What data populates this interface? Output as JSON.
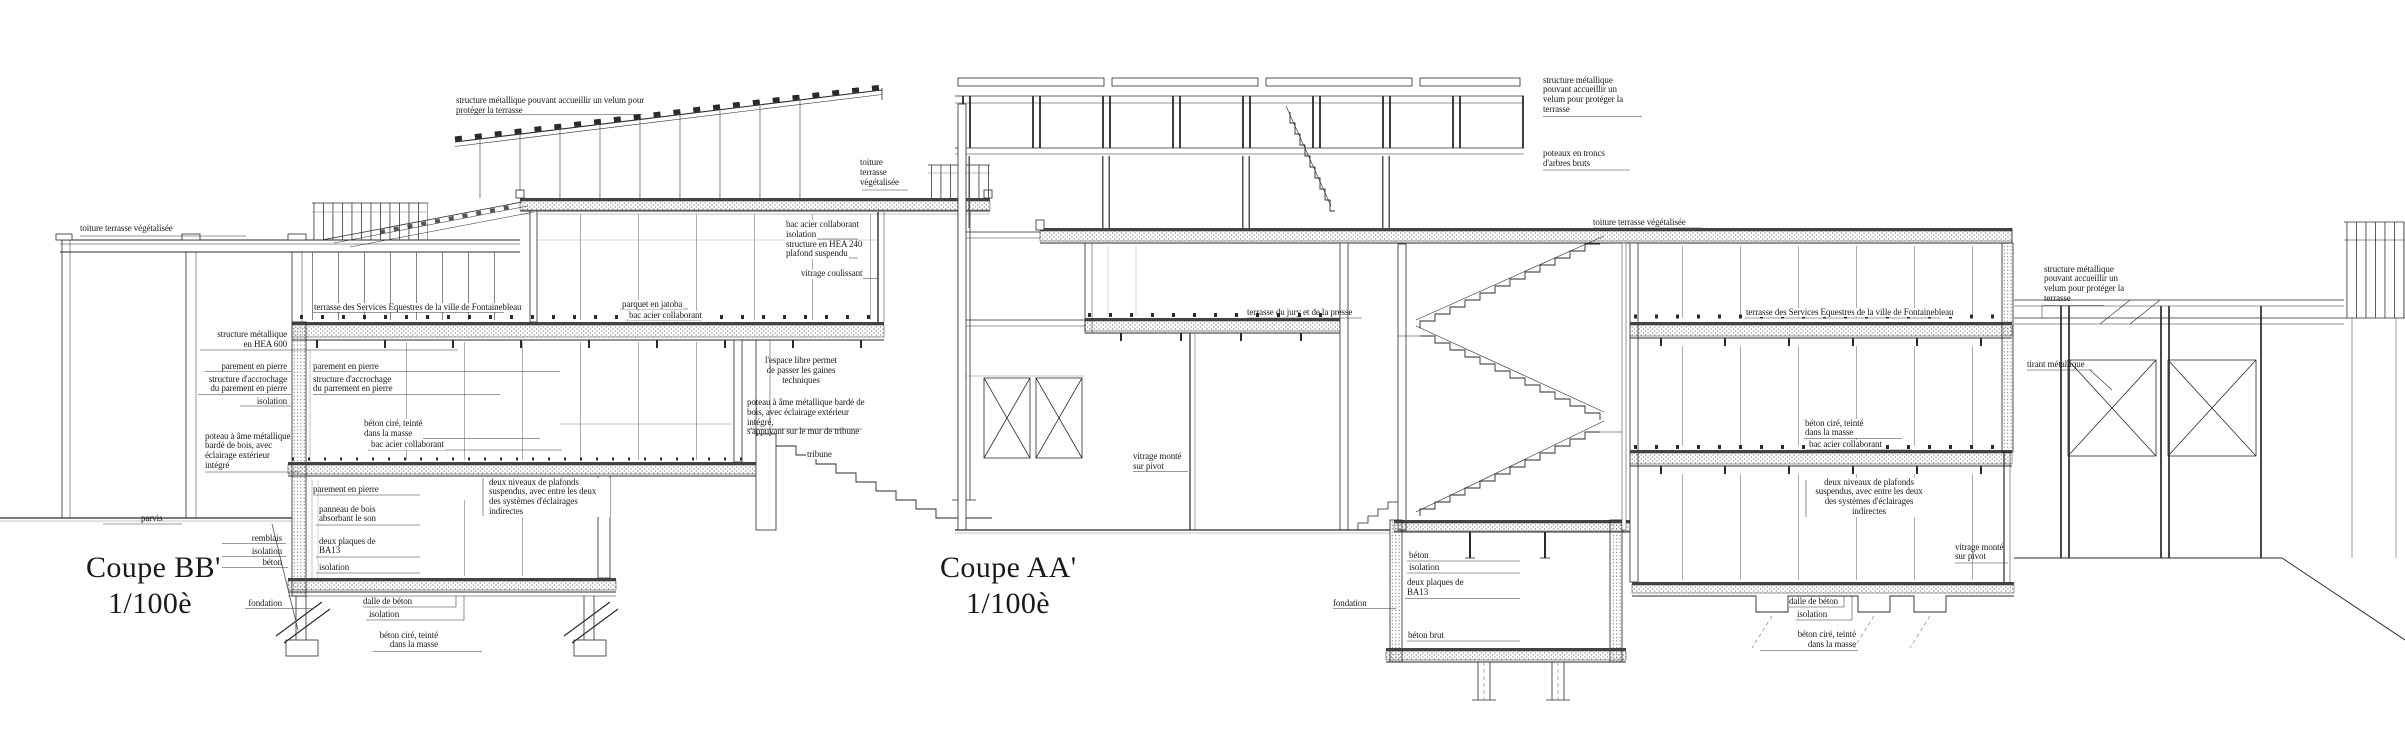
{
  "colors": {
    "ink": "#1a1a1a",
    "paper": "#ffffff"
  },
  "sections": {
    "bb": {
      "title": "Coupe BB'",
      "scale": "1/100è",
      "labels": {
        "toiture_left": "toiture terrasse végétalisée",
        "velum": "structure métallique pouvant accueillir un velum pour\nprotéger la terrasse",
        "toiture_right": "toiture\nterrasse\nvégétalisée",
        "bac_acier": "bac acier collaborant",
        "isolation_roof": "isolation",
        "hea240": "structure en HEA 240",
        "plafond": "plafond suspendu",
        "vitrage_coulissant": "vitrage coulissant",
        "terrasse_services": "terrasse des Services Equestres de la ville de Fontainebleau",
        "parquet": "parquet en jatoba",
        "bac_parquet": "bac acier collaborant",
        "hea600": "structure métallique\nen HEA 600",
        "parement_ext": "parement en pierre",
        "accrochage_ext": "structure d'accrochage\ndu parement en pierre",
        "isolation_wall": "isolation",
        "parement_int": "parement en pierre",
        "accrochage_int": "structure d'accrochage\ndu parrement en pierre",
        "beton_cire": "béton ciré, teinté\ndans la masse",
        "bac_mid": "bac acier collaborant",
        "poteau": "poteau à âme métallique\nbardé de bois, avec\néclairage extérieur\nintégré",
        "espace_libre": "l'espace libre permet\nde passer les gaines\ntechniques",
        "poteau_tribune": "poteau à âme métallique bardé de\nbois, avec éclairage extérieur intégré,\ns'appuyant sur le mur de tribune",
        "tribune": "tribune",
        "parvis": "parvis",
        "remblais": "remblais",
        "isolation_sol": "isolation",
        "beton_sol": "béton",
        "fondation": "fondation",
        "parement_bas": "parement en pierre",
        "panneau_bois": "panneau de bois\nabsorbant le son",
        "ba13": "deux plaques de\nBA13",
        "isolation_bas": "isolation",
        "plafonds": "deux niveaux de plafonds\nsuspendus, avec entre les deux\ndes systèmes d'éclairages\nindirectes",
        "dalle": "dalle de béton",
        "isolation_dalle": "isolation",
        "beton_cire_bas": "béton ciré, teinté\ndans la masse"
      }
    },
    "aa": {
      "title": "Coupe AA'",
      "scale": "1/100è",
      "labels": {
        "velum_haut": "structure métallique\npouvant accueillir un\nvelum pour protéger la\nterrasse",
        "poteaux_troncs": "poteaux en troncs\nd'arbres bruts",
        "toiture": "toiture terrasse végétalisée",
        "terrasse_jury": "terrasse du jury et de la presse",
        "terrasse_services": "terrasse des Services Equestres de la ville de Fontainebleau",
        "velum_droit": "structure métallique\npouvant accueillir un\nvelum pour protéger la\nterrasse",
        "tirant": "tirant métallique",
        "vitrage_gauche": "vitrage monté\nsur pivot",
        "beton_cire": "béton ciré, teinté\ndans la masse",
        "bac_mid": "bac acier collaborant",
        "plafonds": "deux niveaux de plafonds\nsuspendus, avec entre les deux\ndes systèmes d'éclairages\nindirectes",
        "beton": "béton",
        "isolation_mur": "isolation",
        "ba13": "deux plaques de\nBA13",
        "fondation": "fondation",
        "beton_brut": "béton brut",
        "vitrage_droit": "vitrage monté\nsur pivot",
        "dalle": "dalle de béton",
        "isolation_dalle": "isolation",
        "beton_cire_bas": "béton ciré, teinté\ndans la masse"
      }
    }
  }
}
